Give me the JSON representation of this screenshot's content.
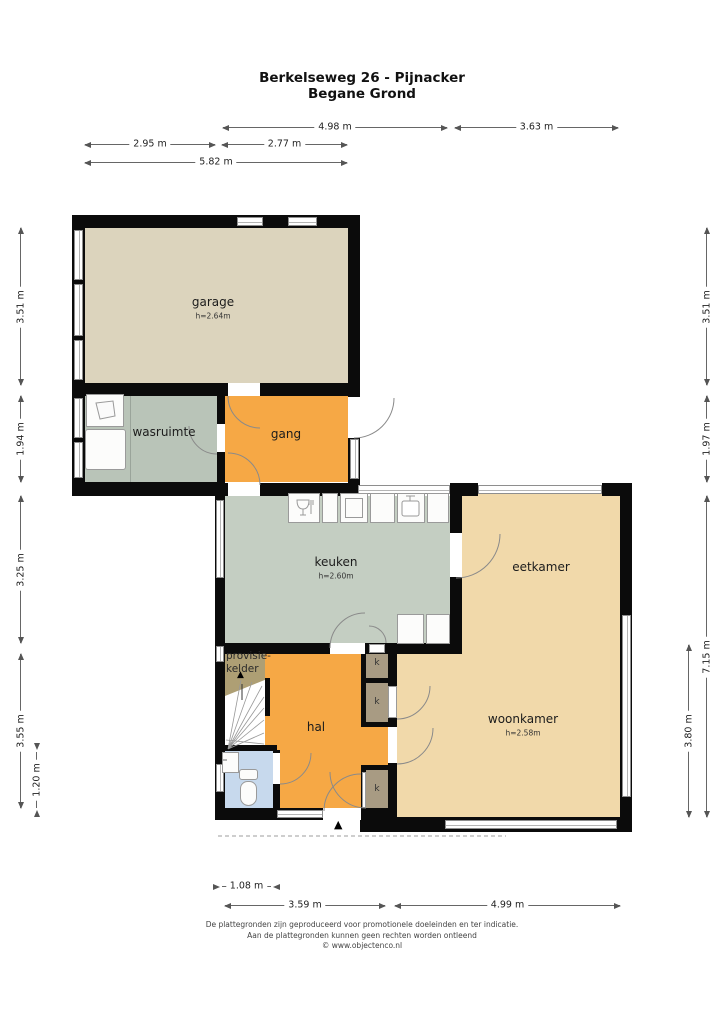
{
  "title": {
    "line1": "Berkelseweg 26 - Pijnacker",
    "line2": "Begane Grond"
  },
  "rooms": {
    "garage": {
      "label": "garage",
      "height": "h=2.64m"
    },
    "wasruimte": {
      "label": "wasruimte"
    },
    "gang": {
      "label": "gang"
    },
    "keuken": {
      "label": "keuken",
      "height": "h=2.60m"
    },
    "eetkamer": {
      "label": "eetkamer"
    },
    "woonkamer": {
      "label": "woonkamer",
      "height": "h=2.58m"
    },
    "hal": {
      "label": "hal"
    },
    "provisiekelder": {
      "line1": "provisie-",
      "line2": "kelder"
    },
    "kast": {
      "label": "k"
    }
  },
  "dimensions": {
    "top": [
      {
        "label": "4.98 m"
      },
      {
        "label": "3.63 m"
      },
      {
        "label": "2.95 m"
      },
      {
        "label": "2.77 m"
      },
      {
        "label": "5.82 m"
      }
    ],
    "left": [
      {
        "label": "3.51 m"
      },
      {
        "label": "1.94 m"
      },
      {
        "label": "3.25 m"
      },
      {
        "label": "3.55 m"
      },
      {
        "label": "1.20 m"
      }
    ],
    "right": [
      {
        "label": "3.51 m"
      },
      {
        "label": "1.97 m"
      },
      {
        "label": "7.15 m"
      },
      {
        "label": "3.80 m"
      }
    ],
    "bottom": [
      {
        "label": "1.08 m"
      },
      {
        "label": "3.59 m"
      },
      {
        "label": "4.99 m"
      }
    ]
  },
  "markers": {
    "entrance_arrow": "▲",
    "stairs_up_arrow": "▲"
  },
  "footer": {
    "line1": "De plattegronden zijn geproduceerd voor promotionele doeleinden en ter indicatie.",
    "line2": "Aan de plattegronden kunnen geen rechten worden ontleend",
    "line3": "© www.objectenco.nl"
  },
  "colors": {
    "wall": "#0b0b0b",
    "garage": "#dcd4bd",
    "utility": "#b9c4b8",
    "kitchen": "#c4cec2",
    "hallway": "#f6a845",
    "living": "#f1d9aa",
    "pantry": "#ae9f74",
    "closet": "#a89b83",
    "toilet": "#c7d9ed"
  }
}
